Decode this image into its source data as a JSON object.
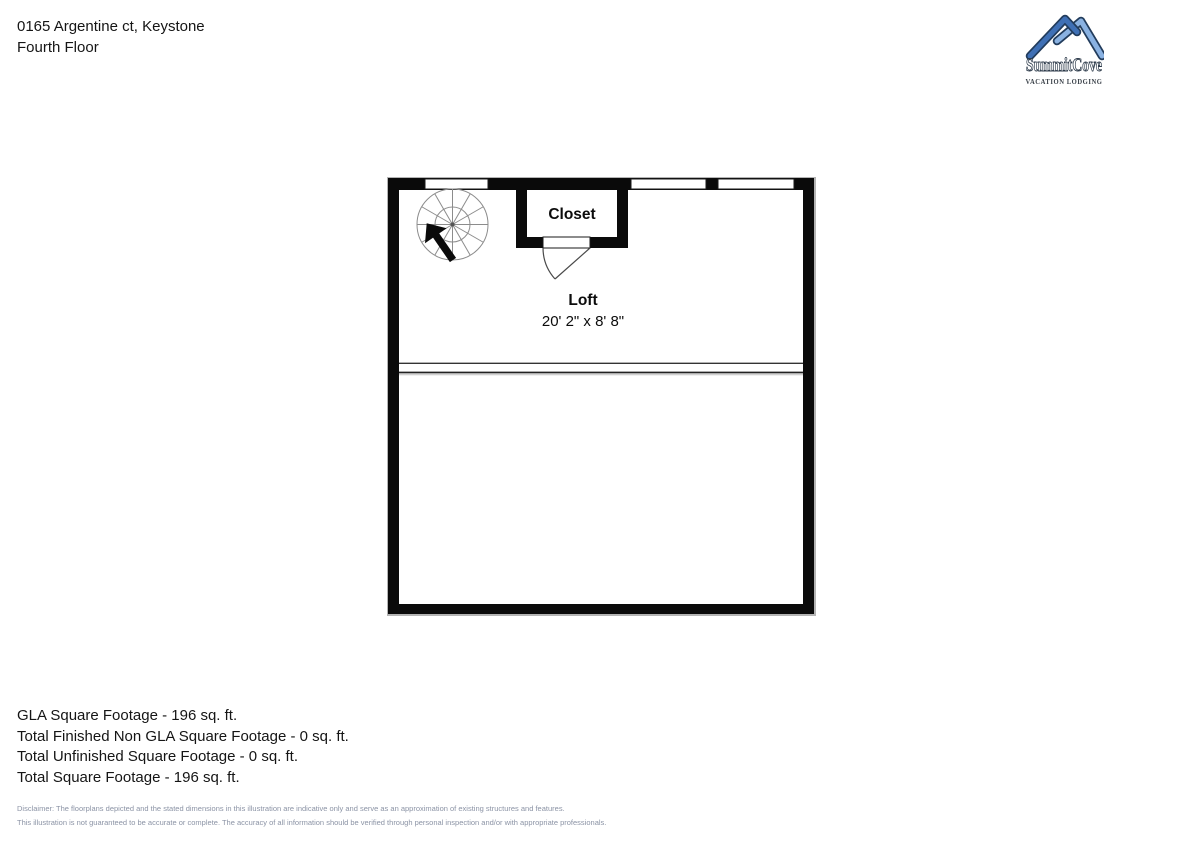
{
  "header": {
    "address": "0165 Argentine ct, Keystone",
    "floor_label": "Fourth Floor"
  },
  "logo": {
    "brand": "SummitCove",
    "tagline": "VACATION LODGING",
    "colors": {
      "mountain_left": "#3f70b5",
      "mountain_right": "#8ab2e2",
      "mountain_outline": "#223c5c",
      "text_outline": "#2c3a4a",
      "tagline_color": "#3a4149"
    }
  },
  "floorplan": {
    "closet": {
      "label": "Closet"
    },
    "loft": {
      "label": "Loft",
      "dimensions": "20' 2\" x 8' 8\""
    }
  },
  "footer": {
    "summary_lines": [
      "GLA Square Footage - 196 sq. ft.",
      "Total Finished Non GLA Square Footage - 0 sq. ft.",
      "Total Unfinished Square Footage - 0 sq. ft.",
      "Total Square Footage - 196 sq. ft."
    ],
    "disclaimer_lines": [
      "Disclaimer: The floorplans depicted and the stated dimensions in this illustration are indicative only and serve as an approximation of existing structures and features.",
      "This illustration is not guaranteed to be accurate or complete. The accuracy of all information should be verified through personal inspection and/or with appropriate professionals."
    ]
  }
}
